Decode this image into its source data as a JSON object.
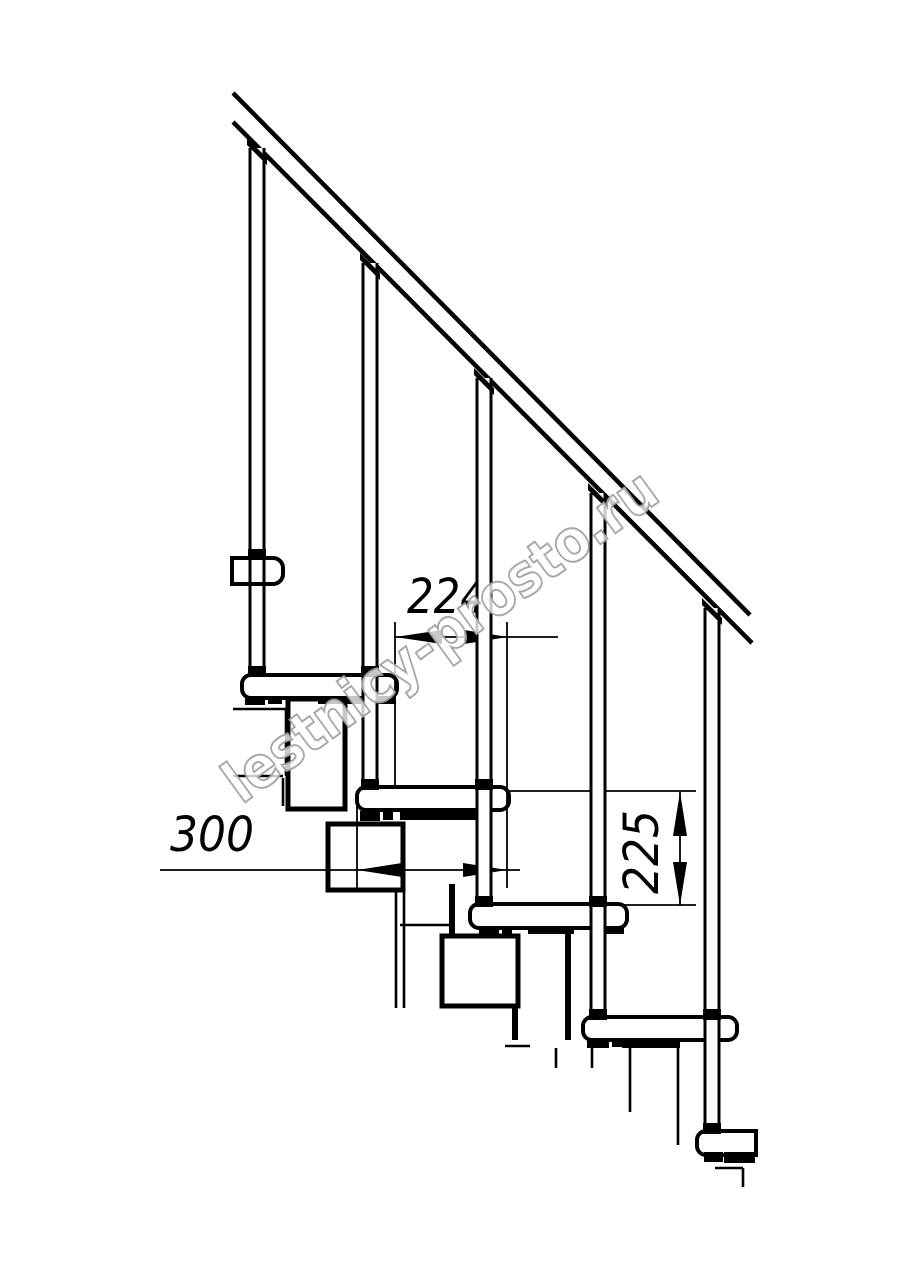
{
  "page": {
    "background": "#ffffff",
    "title": "Modular staircase side-view technical drawing"
  },
  "watermark": {
    "text": "lestnicy-prosto.ru",
    "cx": 452,
    "cy": 652,
    "rotation": -36,
    "font_size": 58,
    "text_length": 520,
    "fill": "#ffffff",
    "stroke": "#9f9f9f",
    "fill_opacity": 0.78,
    "stroke_opacity": 0.9
  },
  "drawing": {
    "ink": "#000000",
    "canvas": {
      "w": 914,
      "h": 1280
    },
    "rail": {
      "fill_points": "233,93 750,615 752,643 233,122",
      "lines": [
        [
          233,
          93,
          750,
          615
        ],
        [
          233,
          122,
          752,
          643
        ]
      ],
      "stroke_width": 4.5
    },
    "spine": {
      "thin_width": 2.6,
      "thin_lines": [
        [
          233,
          709,
          288,
          709
        ],
        [
          233,
          776,
          283,
          776
        ],
        [
          286,
          709,
          286,
          776
        ],
        [
          283,
          778,
          283,
          806
        ],
        [
          396,
          890,
          396,
          1008
        ],
        [
          404,
          890,
          404,
          1008
        ],
        [
          400,
          925,
          450,
          925
        ],
        [
          505,
          1046,
          530,
          1046
        ],
        [
          556,
          1048,
          556,
          1068
        ],
        [
          592,
          1048,
          592,
          1068
        ],
        [
          630,
          1048,
          630,
          1112
        ],
        [
          678,
          1043,
          678,
          1145
        ],
        [
          715,
          1168,
          743,
          1168
        ],
        [
          743,
          1168,
          743,
          1187
        ]
      ],
      "thick_line_width": 6,
      "thick_lines": [
        [
          452,
          884,
          452,
          937
        ],
        [
          515,
          1005,
          515,
          1040
        ],
        [
          568,
          929,
          568,
          1040
        ]
      ],
      "module_stroke_width": 5,
      "module_boxes": [
        [
          288,
          699,
          57,
          110
        ],
        [
          328,
          824,
          75,
          66
        ],
        [
          442,
          936,
          76,
          70
        ]
      ]
    },
    "tread_stroke_width": 4,
    "treads": [
      {
        "name": "tread-1",
        "x": 242,
        "y": 675,
        "w": 155,
        "h": 23,
        "rl": 9,
        "rr": 9
      },
      {
        "name": "tread-2",
        "x": 357,
        "y": 787,
        "w": 152,
        "h": 23,
        "rl": 9,
        "rr": 9
      },
      {
        "name": "tread-3",
        "x": 470,
        "y": 904,
        "w": 157,
        "h": 24,
        "rl": 9,
        "rr": 9
      },
      {
        "name": "tread-4",
        "x": 583,
        "y": 1017,
        "w": 154,
        "h": 23,
        "rl": 9,
        "rr": 9
      },
      {
        "name": "tread-5",
        "x": 697,
        "y": 1131,
        "w": 59,
        "h": 24,
        "rl": 9,
        "rr": 0
      }
    ],
    "upper_bracket": {
      "name": "upper-rail-bracket",
      "x": 232,
      "y": 558,
      "w": 51,
      "h": 26,
      "rl": 0,
      "rr": 10
    },
    "baluster_half_width": 7,
    "baluster_edge_width": 3,
    "balusters": [
      {
        "name": "baluster-1",
        "c": 257,
        "top": 148,
        "bottom": 677
      },
      {
        "name": "baluster-2",
        "c": 370,
        "top": 263,
        "bottom": 788
      },
      {
        "name": "baluster-3",
        "c": 484,
        "top": 378,
        "bottom": 905
      },
      {
        "name": "baluster-4",
        "c": 598,
        "top": 493,
        "bottom": 1018
      },
      {
        "name": "baluster-5",
        "c": 712,
        "top": 608,
        "bottom": 1132
      }
    ],
    "rail_caps": [
      "247,138 267,158 267,165 247,145",
      "360,253 380,273 380,280 360,260",
      "474,368 494,388 494,395 474,375",
      "588,483 608,503 608,510 588,490",
      "702,598 722,618 722,625 702,605"
    ],
    "black_marks": [
      [
        245,
        696,
        20,
        9
      ],
      [
        268,
        696,
        14,
        8
      ],
      [
        318,
        696,
        78,
        8
      ],
      [
        360,
        811,
        20,
        10
      ],
      [
        383,
        811,
        10,
        9
      ],
      [
        400,
        812,
        88,
        8
      ],
      [
        479,
        926,
        20,
        9
      ],
      [
        502,
        926,
        10,
        8
      ],
      [
        528,
        926,
        46,
        8
      ],
      [
        594,
        927,
        30,
        7
      ],
      [
        587,
        1039,
        22,
        9
      ],
      [
        612,
        1039,
        10,
        8
      ],
      [
        622,
        1039,
        58,
        9
      ],
      [
        704,
        1152,
        19,
        10
      ],
      [
        724,
        1152,
        31,
        11
      ]
    ],
    "collars": [
      [
        248,
        549,
        18,
        10
      ],
      [
        248,
        666,
        18,
        11
      ],
      [
        361,
        666,
        18,
        11
      ],
      [
        361,
        779,
        18,
        11
      ],
      [
        475,
        779,
        18,
        11
      ],
      [
        475,
        896,
        18,
        11
      ],
      [
        589,
        896,
        18,
        11
      ],
      [
        589,
        1009,
        18,
        11
      ],
      [
        703,
        1009,
        18,
        11
      ],
      [
        703,
        1123,
        18,
        11
      ]
    ]
  },
  "dimensions": {
    "stroke": "#000000",
    "line_width": 1.8,
    "font_size": 48,
    "lines": [
      [
        395,
        637,
        558,
        637
      ],
      [
        160,
        870,
        520,
        870
      ],
      [
        680,
        792,
        680,
        905
      ],
      [
        395,
        622,
        395,
        788
      ],
      [
        507,
        622,
        507,
        888
      ],
      [
        357,
        806,
        357,
        890
      ],
      [
        507,
        791,
        696,
        791
      ],
      [
        622,
        905,
        696,
        905
      ]
    ],
    "arrows": [
      "395,637 442,630 442,644",
      "508,637 464,630 464,644",
      "357,870 402,863 402,877",
      "507,870 463,863 463,877",
      "680,792 673,836 687,836",
      "680,905 673,862 687,862"
    ],
    "labels": [
      {
        "name": "dim-going-224",
        "text": "224",
        "x": 447,
        "y": 613,
        "rotation": 0,
        "text_length": 80
      },
      {
        "name": "dim-module-300",
        "text": "300",
        "x": 212,
        "y": 851,
        "rotation": 0,
        "text_length": 84
      },
      {
        "name": "dim-rise-225",
        "text": "225",
        "x": 658,
        "y": 852,
        "rotation": -90,
        "text_length": 84
      }
    ]
  }
}
